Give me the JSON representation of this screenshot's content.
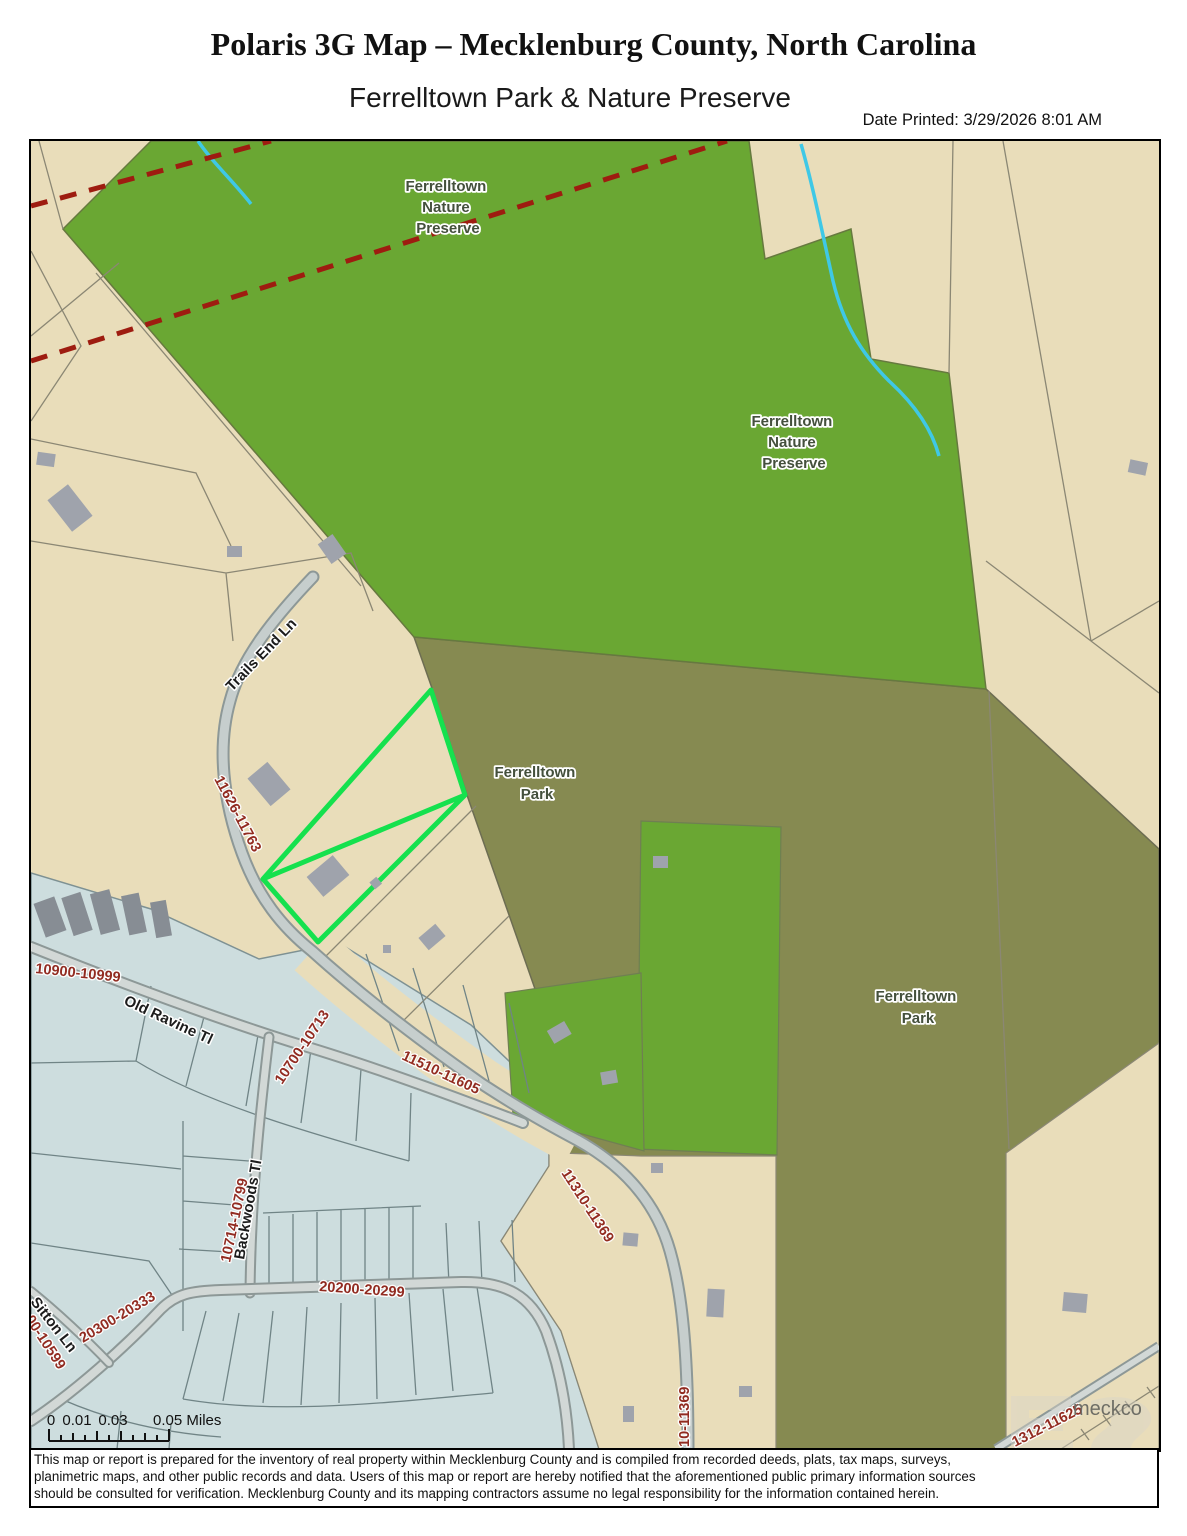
{
  "header": {
    "title": "Polaris 3G Map – Mecklenburg County, North Carolina",
    "subtitle": "Ferrelltown Park & Nature Preserve",
    "date_printed": "Date Printed: 3/29/2026 8:01 AM"
  },
  "map": {
    "region_labels": [
      {
        "id": "nature-preserve-1",
        "lines": [
          "Ferrelltown",
          "Nature",
          "Preserve"
        ]
      },
      {
        "id": "nature-preserve-2",
        "lines": [
          "Ferrelltown",
          "Nature",
          "Preserve"
        ]
      },
      {
        "id": "park-1",
        "lines": [
          "Ferrelltown",
          "Park"
        ]
      },
      {
        "id": "park-2",
        "lines": [
          "Ferrelltown",
          "Park"
        ]
      }
    ],
    "street_labels": [
      {
        "id": "trails-end-ln",
        "text": "Trails End Ln"
      },
      {
        "id": "old-ravine-tl",
        "text": "Old Ravine Tl"
      },
      {
        "id": "backwoods-tl",
        "text": "Backwoods Tl"
      },
      {
        "id": "sitton-ln",
        "text": "Sitton Ln"
      }
    ],
    "address_labels": [
      {
        "id": "range-trails-end",
        "text": "11626-11763"
      },
      {
        "id": "range-10900",
        "text": "10900-10999"
      },
      {
        "id": "range-10700",
        "text": "10700-10713"
      },
      {
        "id": "range-11510",
        "text": "11510-11605"
      },
      {
        "id": "range-10714",
        "text": "10714-10799"
      },
      {
        "id": "range-20200",
        "text": "20200-20299"
      },
      {
        "id": "range-20300",
        "text": "20300-20333"
      },
      {
        "id": "range-10599",
        "text": "00-10599"
      },
      {
        "id": "range-11310",
        "text": "11310-11369"
      },
      {
        "id": "range-11369",
        "text": "10-11369"
      },
      {
        "id": "range-11625",
        "text": "1312-11625"
      }
    ],
    "watermark": "meckco",
    "colors": {
      "parcel_tan": "#e9ddba",
      "preserve_green": "#6aa733",
      "park_olive": "#868a51",
      "subdivision_blue": "#cdddde",
      "highlight_green": "#15e14e",
      "boundary_dashed_red": "#9e1c10",
      "creek_cyan": "#3fc8e6",
      "address_red": "#8f2318",
      "building_gray": "#9fa3ac"
    }
  },
  "scale_bar": {
    "labels": [
      "0",
      "0.01",
      "0.03"
    ],
    "end_label": "0.05 Miles"
  },
  "disclaimer_lines": [
    "This map or report is prepared for the inventory of real property within Mecklenburg County and is compiled from recorded deeds, plats, tax maps, surveys,",
    "planimetric maps, and other public records and data. Users of this map or report are hereby notified that the aforementioned public primary information sources",
    "should be consulted for verification. Mecklenburg County and its mapping contractors assume no legal responsibility for the information contained herein."
  ]
}
